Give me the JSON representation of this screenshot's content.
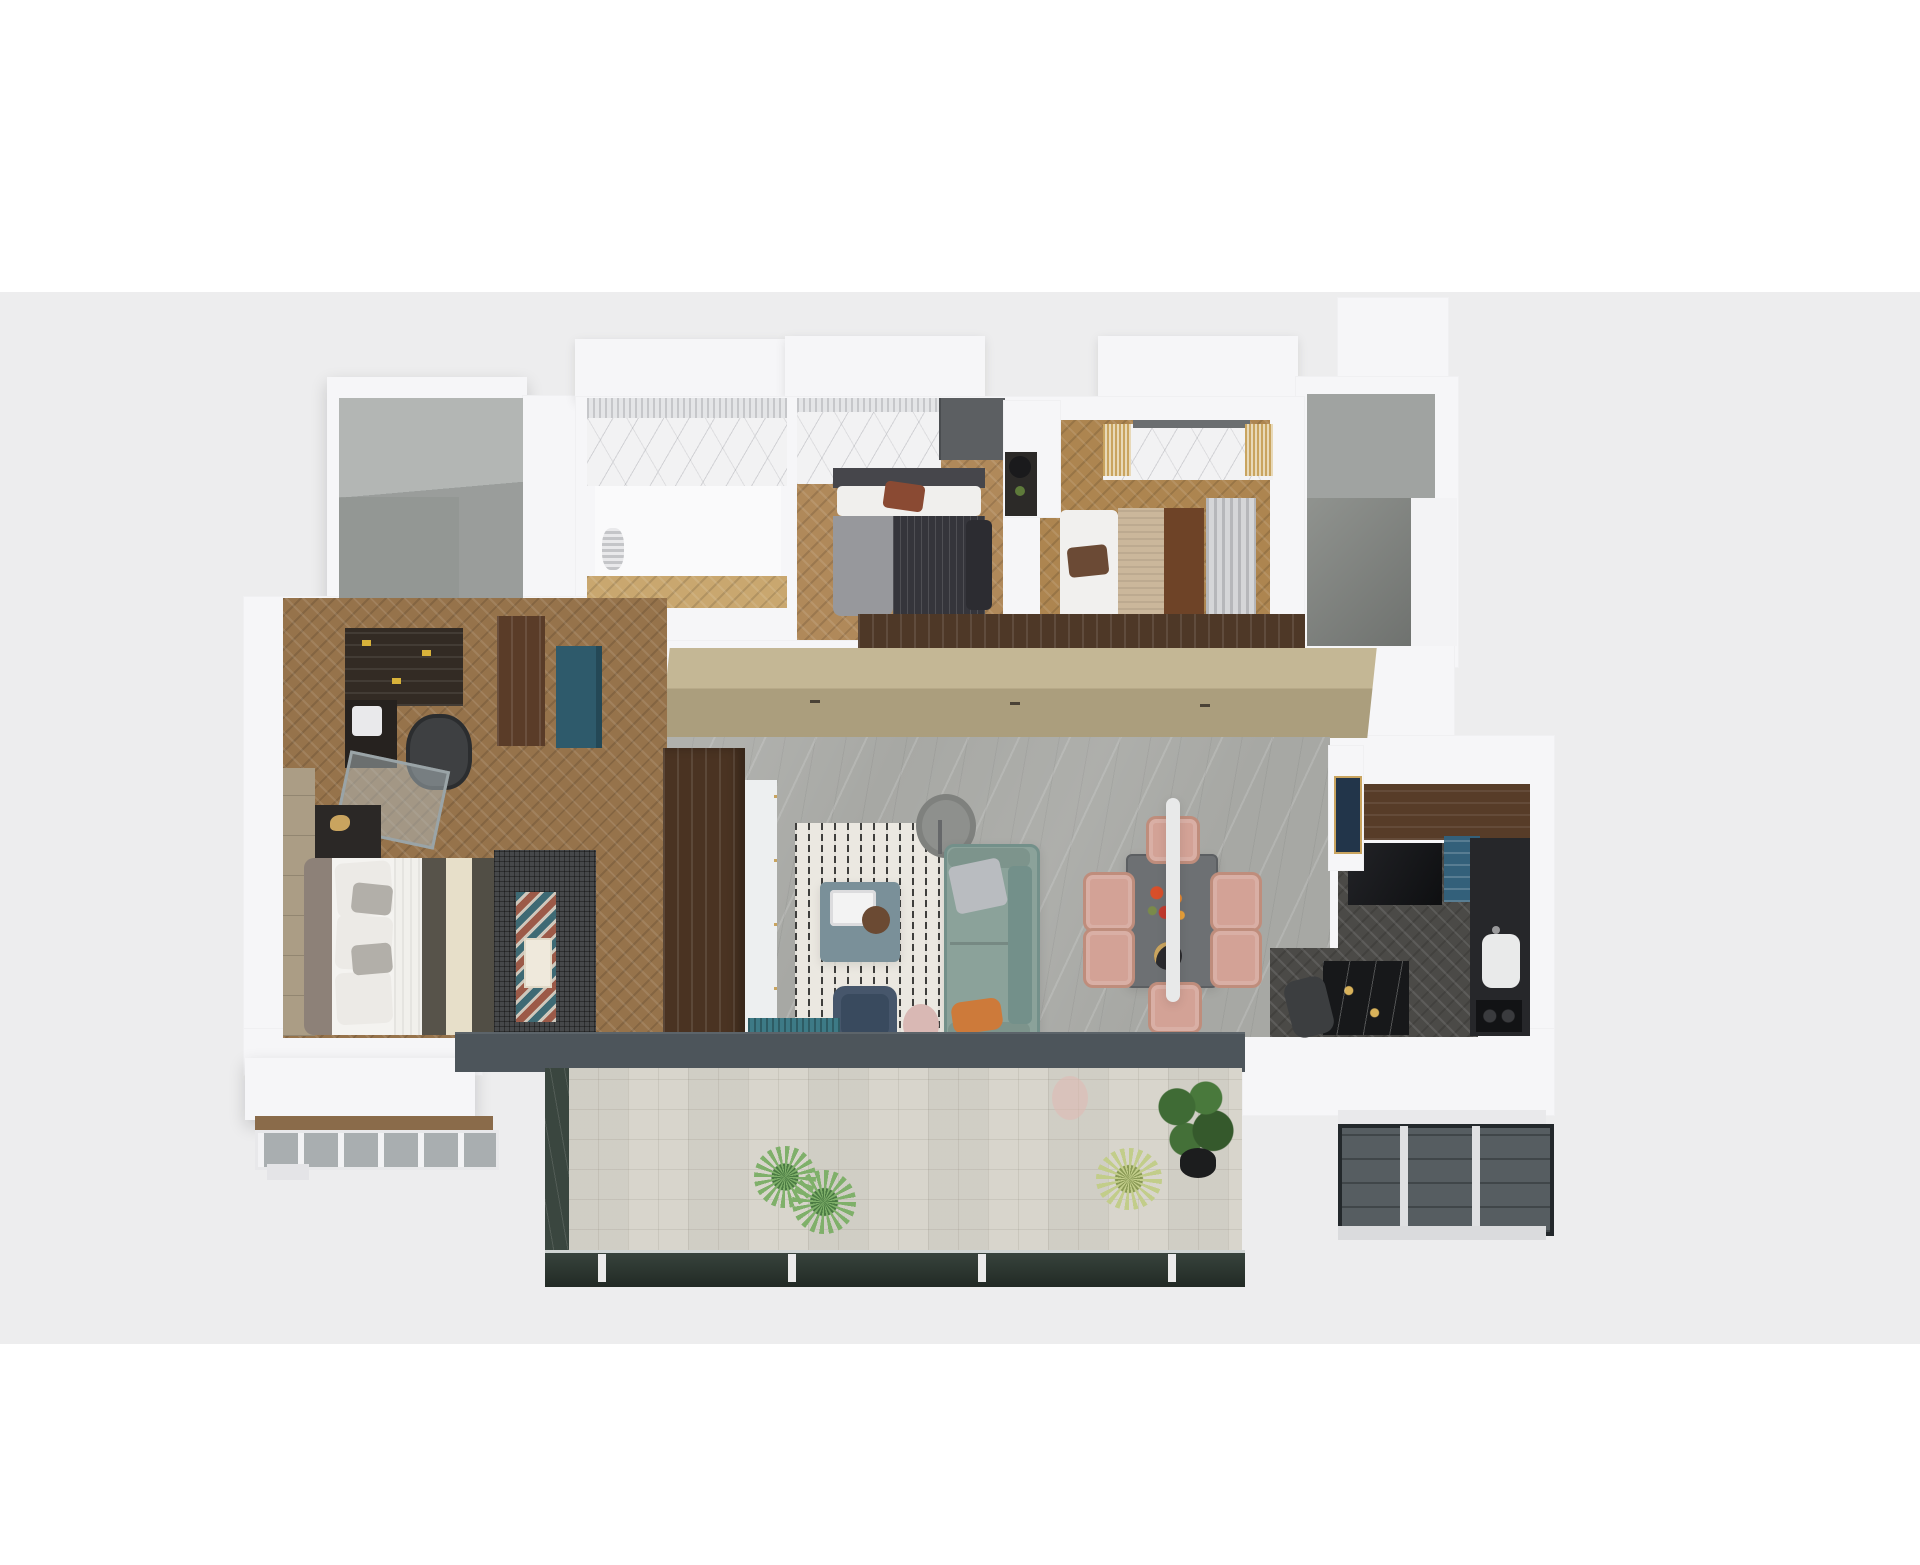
{
  "scene": {
    "description": "Photorealistic axonometric 3D floor plan render of a three-bedroom apartment viewed from above, centered on a white-to-light-gray backdrop with no visible text or labels",
    "view": "top-down axonometric",
    "no_visible_text": true
  },
  "palette": {
    "page_background": "#ffffff",
    "backdrop_band": "#ededee",
    "walls": "#f6f6f8",
    "void_gray": "#9a9d9b",
    "wardrobe_tan": "#b5a885",
    "walnut_wood": "#4f3a28",
    "bedroom_wood_floor": "#ad8550",
    "master_wood_floor": "#96734b",
    "living_marble_floor": "#a7a8a4",
    "headboard_marble": "#f2f2f3",
    "kitchen_floor": "#4b4a47",
    "balcony_tile": "#d8d5cc",
    "balcony_stone": "#3a463f",
    "door_track_slate": "#4d555b",
    "sofa_sage_green": "#8ba29a",
    "dining_chair_blush": "#d3a296",
    "accent_teal": "#2e5a6b",
    "accent_navy": "#3c4d63",
    "accent_orange": "#cd7a3a",
    "accent_gold": "#c9a45f",
    "plant_green": "#7fb06a"
  },
  "rooms": [
    {
      "id": "void-top-left",
      "name": "unfinished gray room (adjacent unit / shaft)",
      "items": [
        "empty gray floor"
      ]
    },
    {
      "id": "dressing-room",
      "name": "dressing / vanity room",
      "items": [
        "marble splashback",
        "sheer curtain",
        "white vanity table",
        "light chevron wood floor"
      ]
    },
    {
      "id": "bedroom-2",
      "name": "second bedroom",
      "items": [
        "marble headboard wall",
        "dark charcoal bed",
        "gray throw blanket",
        "rust accent pillow",
        "dark wardrobe",
        "walnut foot bench",
        "chevron wood floor"
      ]
    },
    {
      "id": "bedroom-3",
      "name": "third bedroom",
      "items": [
        "marble headboard wall with gold curtain tassels",
        "tan textured bed",
        "brown runner",
        "black nightstand with lamp",
        "gray curtain",
        "chevron wood floor"
      ]
    },
    {
      "id": "void-top-right",
      "name": "unfinished gray L-shaped core (stair / elevator)",
      "items": [
        "stepped gray floor"
      ]
    },
    {
      "id": "hallway",
      "name": "hallway with full-width wardrobe",
      "items": [
        "tan wardrobe doors",
        "walnut upper strip",
        "door handles"
      ]
    },
    {
      "id": "master-suite",
      "name": "master bedroom with study corner",
      "items": [
        "dark bookshelf with yellow books",
        "black desk",
        "office chair",
        "glass partition",
        "brown cabinet",
        "teal cabinet",
        "taupe bed with olive and cream runners",
        "gray pillows",
        "dark nightstand with gold decor",
        "dark lattice bench rug",
        "teal-rust zigzag runner",
        "chevron wood floor",
        "bay window"
      ]
    },
    {
      "id": "living-room",
      "name": "living room",
      "items": [
        "dark walnut TV partition",
        "white media console",
        "striped shag rug",
        "teal coffee table with tray and basket",
        "sage green sofa",
        "silver pillow",
        "orange pillow",
        "navy armchair",
        "blush round pouf",
        "teal pleated bench",
        "gray floor lamp",
        "gray marble floor"
      ]
    },
    {
      "id": "dining-area",
      "name": "dining area",
      "items": [
        "dark gray dining table",
        "six blush upholstered chairs",
        "orange-red flower centerpiece",
        "black round tray",
        "white linear pendant light"
      ]
    },
    {
      "id": "kitchen",
      "name": "kitchen",
      "items": [
        "white partition with navy-gold artwork",
        "walnut counter band",
        "black glossy counter",
        "teal shelf unit",
        "black counter with white sink",
        "cooktop",
        "black marble island with gold glassware",
        "dark stool",
        "dark chevron floor",
        "bay window"
      ]
    },
    {
      "id": "balcony",
      "name": "balcony",
      "items": [
        "patterned light tile floor",
        "dark green stone border",
        "glass sliding doors on slate track",
        "glass balustrade with white posts",
        "two green plants",
        "pale grass plant",
        "potted fiddle-leaf plant"
      ]
    }
  ]
}
